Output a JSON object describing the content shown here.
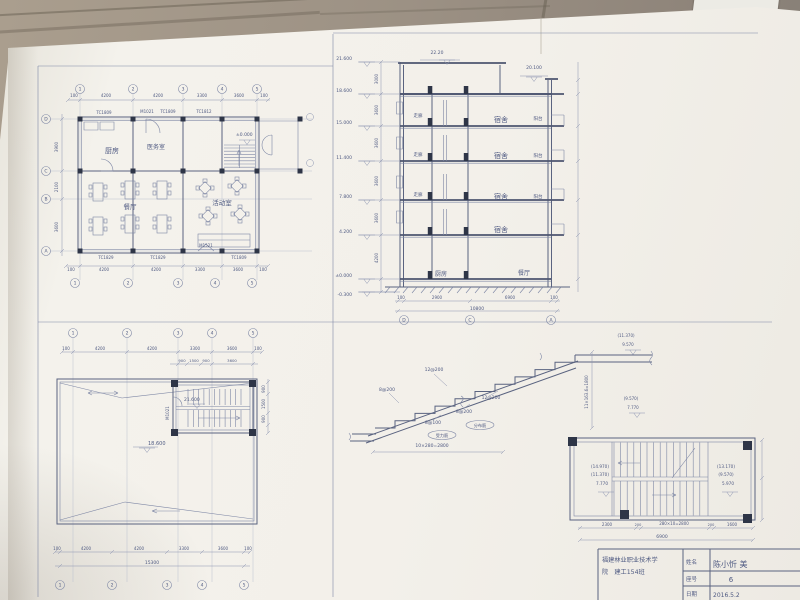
{
  "scene": {
    "floor_color": "#9a8e7f",
    "paper_color": "#f2f0ea"
  },
  "floor_plan": {
    "rooms": {
      "kitchen": "厨房",
      "infirmary": "医务室",
      "dining": "餐厅",
      "activity": "活动室"
    },
    "level": "±0.000",
    "tags_top": [
      "TC1809",
      "M1021",
      "TC1809",
      "TC1812"
    ],
    "tags_bottom": [
      "TC1829",
      "TC1829",
      "M1521",
      "TC1809"
    ],
    "dims_top": [
      "100",
      "4200",
      "4200",
      "3300",
      "3600",
      "100"
    ],
    "dims_bottom": [
      "100",
      "4200",
      "4200",
      "3300",
      "3600",
      "100"
    ],
    "dims_left": [
      "3900",
      "2100",
      "3600"
    ],
    "grid_cols": [
      "1",
      "2",
      "3",
      "4",
      "5"
    ],
    "grid_rows": [
      "D",
      "C",
      "B",
      "A"
    ]
  },
  "section": {
    "levels": [
      "21.600",
      "18.600",
      "15.000",
      "11.400",
      "7.800",
      "4.200",
      "±0.000",
      "-0.300"
    ],
    "heights": [
      "3000",
      "3600",
      "3600",
      "3600",
      "3600",
      "4200"
    ],
    "top_level": "22.20",
    "right_level": "20.100",
    "corridor": [
      "走廊",
      "走廊",
      "走廊"
    ],
    "dorms": [
      "宿舍",
      "宿舍",
      "宿舍",
      "宿舍"
    ],
    "balconies": [
      "阳台",
      "阳台",
      "阳台"
    ],
    "kitchen": "厨房",
    "dining": "餐厅",
    "dims_bottom": [
      "100",
      "2900",
      "6900",
      "100"
    ],
    "total": "10800",
    "grid": [
      "D",
      "C",
      "A"
    ]
  },
  "roof_plan": {
    "roof_level": "18.600",
    "stair_level": "21.600",
    "door_tag": "M1021",
    "dims_top": [
      "100",
      "4200",
      "4200",
      "3300",
      "3600",
      "100"
    ],
    "dims_sub": [
      "900",
      "1500",
      "900",
      "3600"
    ],
    "dims_bottom": [
      "100",
      "4200",
      "4200",
      "3300",
      "3600",
      "100"
    ],
    "dims_right": [
      "900",
      "1500",
      "900"
    ],
    "total": "15300",
    "grid_top": [
      "1",
      "2",
      "3",
      "4",
      "5"
    ],
    "grid_bottom": [
      "1",
      "2",
      "3",
      "4",
      "5"
    ]
  },
  "stair_section": {
    "rebar_top": "12@200",
    "rebar_left": "8@200",
    "rebar_mid": "12@200",
    "rebar_dist": "8@200",
    "rebar_main": "8@100",
    "note_dist": "分布筋",
    "note_main": "受力筋",
    "dim_flight": "10×280=2800",
    "dim_riser": "11×163.6=1800",
    "upper_levels": [
      "(11.370)",
      "9.570"
    ],
    "lower_levels": [
      "(9.570)",
      "7.770"
    ]
  },
  "stair_plan": {
    "levels_left": [
      "(14.970)",
      "(11.370)",
      "7.770"
    ],
    "levels_right": [
      "(13.170)",
      "(9.570)",
      "5.970"
    ],
    "dims_bottom": [
      "2300",
      "200",
      "280×10=2800",
      "200",
      "1600"
    ],
    "total": "6900"
  },
  "title_block": {
    "school_line1": "福建林业职业技术学",
    "school_line2": "院　建工154班",
    "name_label": "姓名",
    "name_value": "陈小忻 美",
    "seat_label": "座号",
    "seat_value": "6",
    "date_label": "日期",
    "date_value": "2016.5.2"
  }
}
